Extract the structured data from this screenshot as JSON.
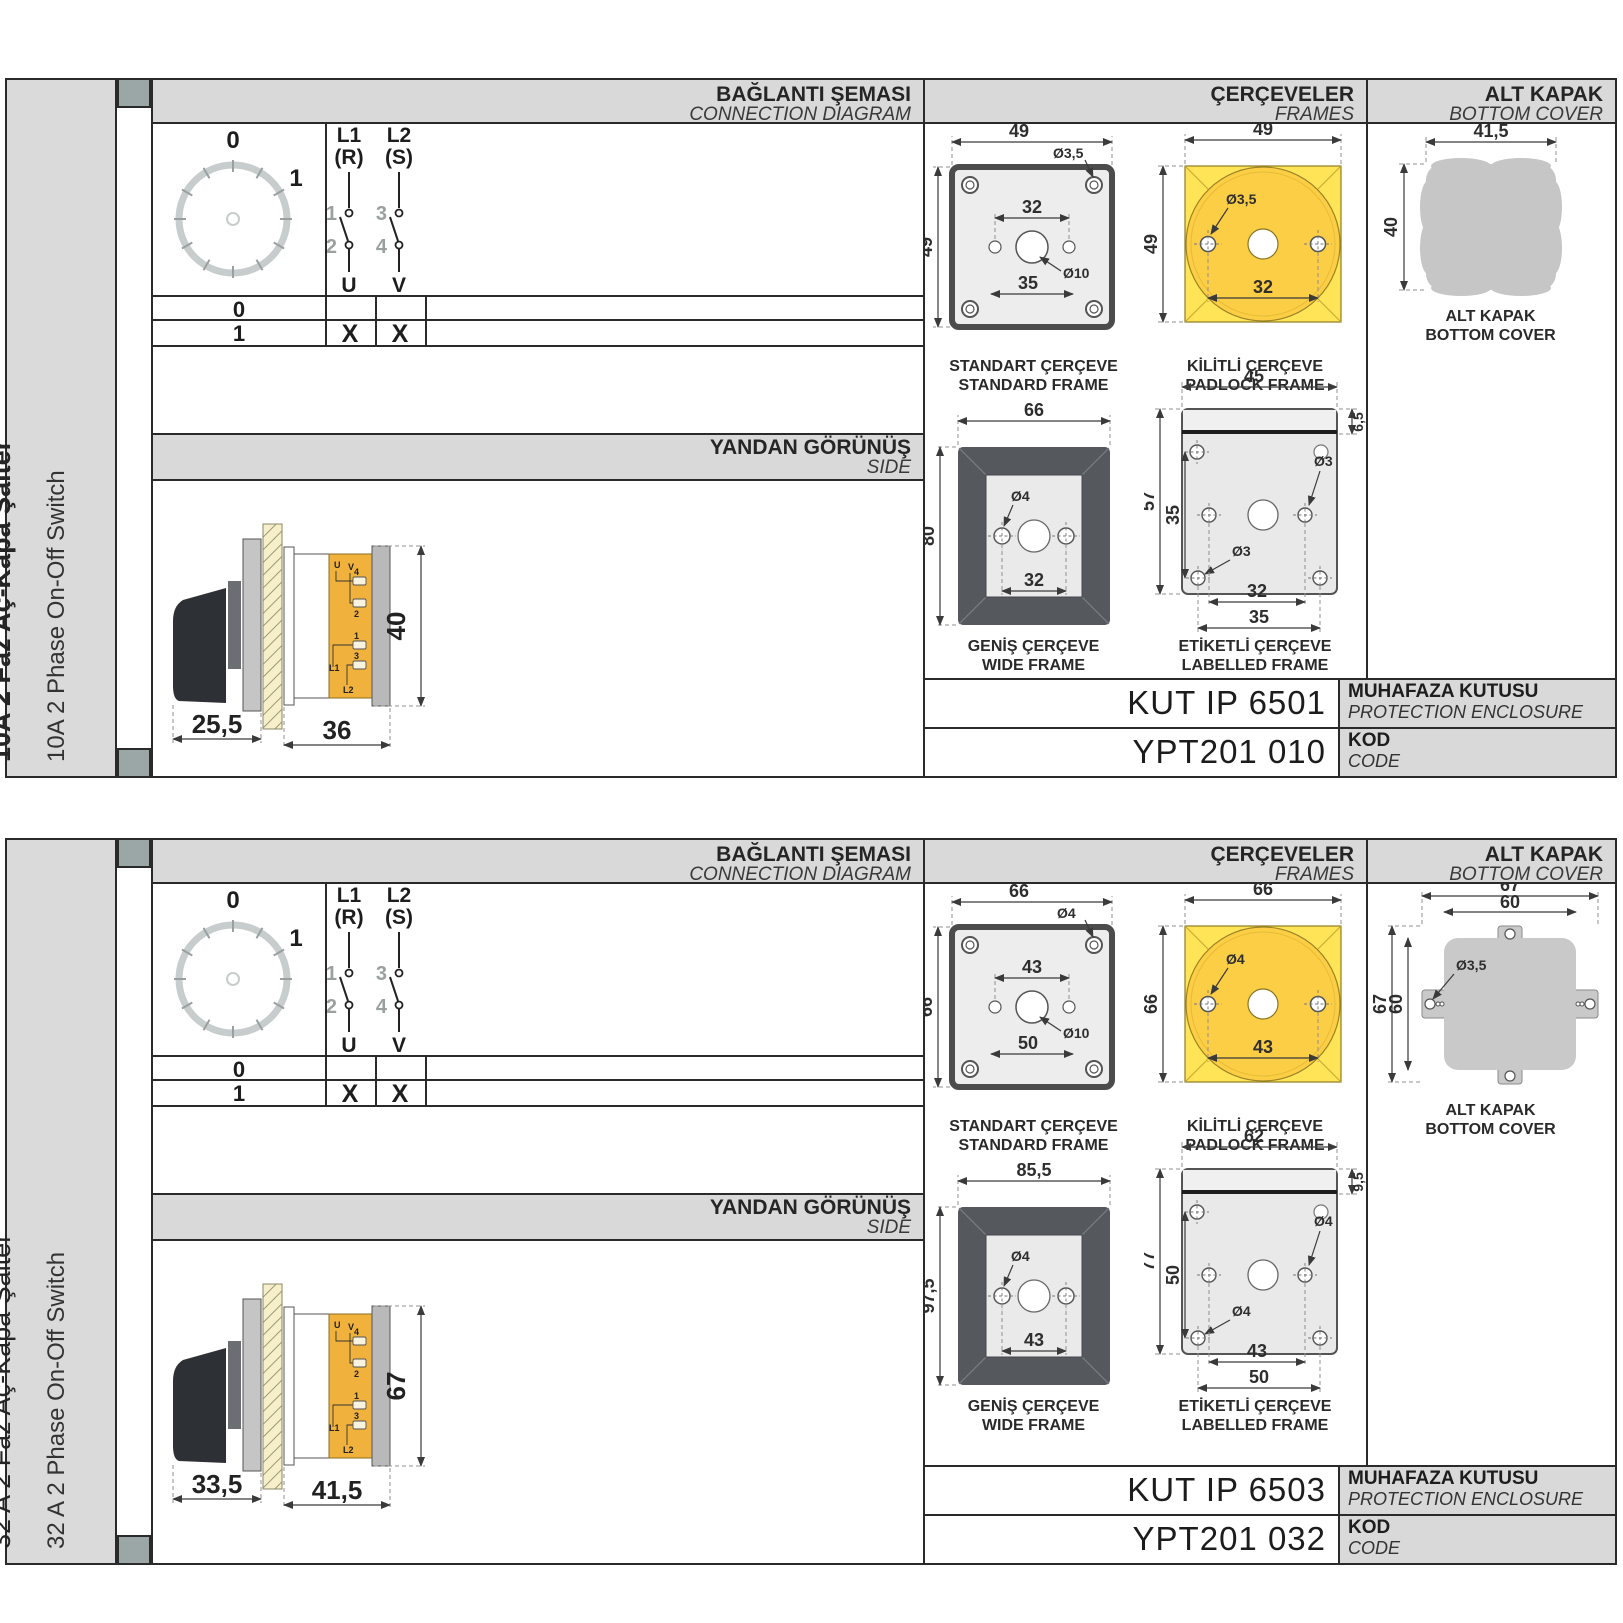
{
  "sections": [
    {
      "sidebar": {
        "title_tr": "10A 2 Faz Aç-Kapa Şalter",
        "title_en": "10A 2 Phase On-Off Switch"
      },
      "headers": {
        "connection_tr": "BAĞLANTI ŞEMASI",
        "connection_en": "CONNECTION DIAGRAM",
        "frames_tr": "ÇERÇEVELER",
        "frames_en": "FRAMES",
        "cover_tr": "ALT KAPAK",
        "cover_en": "BOTTOM COVER",
        "side_tr": "YANDAN GÖRÜNÜŞ",
        "side_en": "SIDE"
      },
      "diagram": {
        "dial": {
          "pos0": "0",
          "pos1": "1"
        },
        "poles": [
          {
            "line": "L1",
            "phase": "(R)",
            "top_no": "1",
            "bottom_no": "2",
            "terminal": "U"
          },
          {
            "line": "L2",
            "phase": "(S)",
            "top_no": "3",
            "bottom_no": "4",
            "terminal": "V"
          }
        ],
        "table": {
          "rows": [
            {
              "label": "0",
              "u": "",
              "v": ""
            },
            {
              "label": "1",
              "u": "X",
              "v": "X"
            }
          ]
        }
      },
      "side_view": {
        "dim_front": "25,5",
        "dim_body": "36",
        "dim_height": "40",
        "labels": {
          "u": "U",
          "v": "V",
          "n4": "4",
          "n2": "2",
          "n1": "1",
          "n3": "3",
          "l1": "L1",
          "l2": "L2"
        }
      },
      "frames": {
        "standard": {
          "caption_tr": "STANDART ÇERÇEVE",
          "caption_en": "STANDARD FRAME",
          "dim_w": "49",
          "dim_h": "49",
          "hole_d": "Ø3,5",
          "dim_holes": "32",
          "dim_lower": "35",
          "center_d": "Ø10"
        },
        "padlock": {
          "caption_tr": "KİLİTLİ ÇERÇEVE",
          "caption_en": "PADLOCK FRAME",
          "dim_w": "49",
          "dim_h": "49",
          "hole_d": "Ø3,5",
          "dim_holes": "32"
        },
        "wide": {
          "caption_tr": "GENİŞ ÇERÇEVE",
          "caption_en": "WIDE FRAME",
          "dim_w": "66",
          "dim_h": "80",
          "hole_d": "Ø4",
          "dim_holes": "32"
        },
        "labelled": {
          "caption_tr": "ETİKETLİ ÇERÇEVE",
          "caption_en": "LABELLED FRAME",
          "dim_w": "45",
          "dim_label_h": "6,5",
          "dim_h": "57",
          "dim_inner_h": "35",
          "hole_d_a": "Ø3",
          "hole_d_b": "Ø3",
          "dim_holes": "32",
          "dim_lower": "35"
        }
      },
      "cover": {
        "caption_tr": "ALT KAPAK",
        "caption_en": "BOTTOM COVER",
        "dim_w": "41,5",
        "dim_h": "40"
      },
      "codes": {
        "enclosure_value": "KUT IP 6501",
        "enclosure_tr": "MUHAFAZA KUTUSU",
        "enclosure_en": "PROTECTION ENCLOSURE",
        "code_value": "YPT201 010",
        "code_tr": "KOD",
        "code_en": "CODE"
      }
    },
    {
      "sidebar": {
        "title_tr": "32 A 2 Faz Aç-Kapa Şalter",
        "title_en": "32 A 2 Phase On-Off Switch"
      },
      "headers": {
        "connection_tr": "BAĞLANTI ŞEMASI",
        "connection_en": "CONNECTION DIAGRAM",
        "frames_tr": "ÇERÇEVELER",
        "frames_en": "FRAMES",
        "cover_tr": "ALT KAPAK",
        "cover_en": "BOTTOM COVER",
        "side_tr": "YANDAN GÖRÜNÜŞ",
        "side_en": "SIDE"
      },
      "diagram": {
        "dial": {
          "pos0": "0",
          "pos1": "1"
        },
        "poles": [
          {
            "line": "L1",
            "phase": "(R)",
            "top_no": "1",
            "bottom_no": "2",
            "terminal": "U"
          },
          {
            "line": "L2",
            "phase": "(S)",
            "top_no": "3",
            "bottom_no": "4",
            "terminal": "V"
          }
        ],
        "table": {
          "rows": [
            {
              "label": "0",
              "u": "",
              "v": ""
            },
            {
              "label": "1",
              "u": "X",
              "v": "X"
            }
          ]
        }
      },
      "side_view": {
        "dim_front": "33,5",
        "dim_body": "41,5",
        "dim_height": "67",
        "labels": {
          "u": "U",
          "v": "V",
          "n4": "4",
          "n2": "2",
          "n1": "1",
          "n3": "3",
          "l1": "L1",
          "l2": "L2"
        }
      },
      "frames": {
        "standard": {
          "caption_tr": "STANDART ÇERÇEVE",
          "caption_en": "STANDARD FRAME",
          "dim_w": "66",
          "dim_h": "66",
          "hole_d": "Ø4",
          "dim_holes": "43",
          "dim_lower": "50",
          "center_d": "Ø10"
        },
        "padlock": {
          "caption_tr": "KİLİTLİ ÇERÇEVE",
          "caption_en": "PADLOCK FRAME",
          "dim_w": "66",
          "dim_h": "66",
          "hole_d": "Ø4",
          "dim_holes": "43"
        },
        "wide": {
          "caption_tr": "GENİŞ ÇERÇEVE",
          "caption_en": "WIDE FRAME",
          "dim_w": "85,5",
          "dim_h": "97,5",
          "hole_d": "Ø4",
          "dim_holes": "43"
        },
        "labelled": {
          "caption_tr": "ETİKETLİ ÇERÇEVE",
          "caption_en": "LABELLED FRAME",
          "dim_w": "62",
          "dim_label_h": "9,5",
          "dim_h": "77",
          "dim_inner_h": "50",
          "hole_d_a": "Ø4",
          "hole_d_b": "Ø4",
          "dim_holes": "43",
          "dim_lower": "50"
        }
      },
      "cover": {
        "caption_tr": "ALT KAPAK",
        "caption_en": "BOTTOM COVER",
        "dim_w_outer": "67",
        "dim_w_inner": "60",
        "dim_h_outer": "67",
        "dim_h_inner": "60",
        "hole_d": "Ø3,5"
      },
      "codes": {
        "enclosure_value": "KUT IP 6503",
        "enclosure_tr": "MUHAFAZA KUTUSU",
        "enclosure_en": "PROTECTION ENCLOSURE",
        "code_value": "YPT201 032",
        "code_tr": "KOD",
        "code_en": "CODE"
      }
    }
  ]
}
